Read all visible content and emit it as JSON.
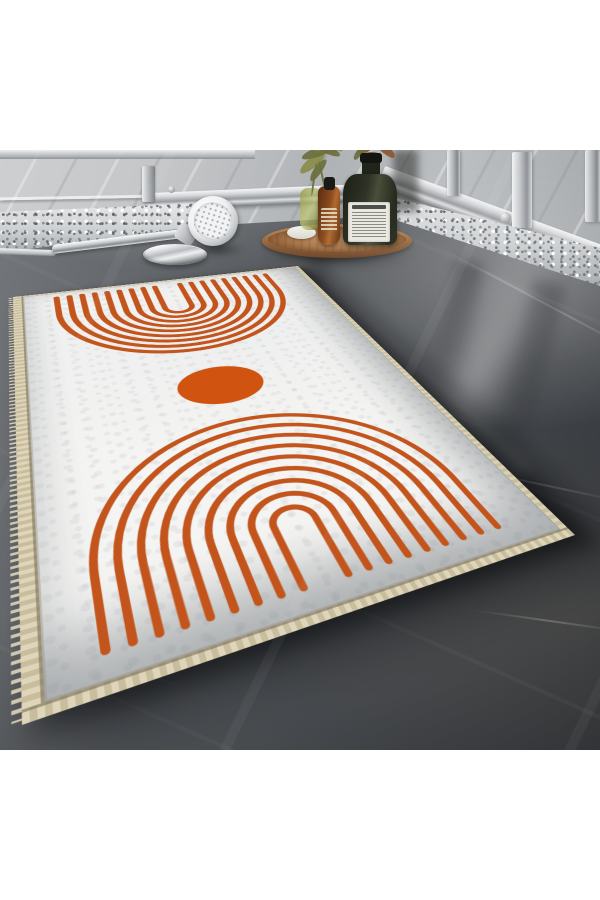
{
  "image_type": "product-photo",
  "subject": "white boho area rug with burnt-orange nested-arch motifs on a dark glossy marble bathroom floor, beside a glass shower screen, granite curb, handheld shower head and a round wooden tray with bottles and greenery",
  "palette": {
    "page-bg": "#ffffff",
    "arc": "#c2541c",
    "circle": "#d0540f",
    "rug-white": "#f4f4f2",
    "binding": "#d8cfb3",
    "binding-dark": "#c8be9e",
    "floor-dark": "#34373b",
    "floor-mid": "#54575b",
    "floor-light": "#75787c",
    "wall-light": "#cbcdcf",
    "wall-mid": "#aeb1b4",
    "granite": "#cfd2d4",
    "chrome-light": "#f4f5f6",
    "chrome-mid": "#b9bcbf",
    "chrome-dark": "#7f8285",
    "wood-light": "#c2905f",
    "wood-mid": "#a5754a",
    "wood-dark": "#6e4526",
    "bottle-glass": "#2e3326",
    "label-white": "#e9e7e0",
    "amber": "#8a4a1e",
    "green-glass": "#9aa050",
    "leaf-green": "#8c8e4b",
    "leaf-olive": "#6d713f",
    "leaf-dry": "#8a5a35"
  },
  "rug": {
    "design": {
      "canvas": {
        "w": 300,
        "h": 460
      },
      "top_motif": {
        "shape": "nested-arches",
        "opening": "up",
        "count": 9,
        "cx": 147,
        "tips_v": 14,
        "r_start": 13,
        "r_step": 11.9,
        "center_v": 70,
        "center_v_step": -2,
        "stroke": 5.5
      },
      "circle": {
        "cx": 148,
        "cy": 225,
        "rx": 34,
        "ry": 28
      },
      "bottom_motif": {
        "shape": "nested-arches",
        "opening": "down",
        "count": 9,
        "cx": 148,
        "tips_v": 437,
        "r_start": 13,
        "r_step": 12.4,
        "center_v": 390,
        "center_v_step": 0,
        "stroke": 4.5
      }
    }
  },
  "tray": {
    "leaves": [
      {
        "x": 42,
        "y": 18,
        "w": 30,
        "h": 10,
        "rot": -38,
        "c": "leaf-green"
      },
      {
        "x": 46,
        "y": 8,
        "w": 32,
        "h": 9,
        "rot": -18,
        "c": "leaf-olive"
      },
      {
        "x": 55,
        "y": 2,
        "w": 30,
        "h": 9,
        "rot": -2,
        "c": "leaf-green"
      },
      {
        "x": 60,
        "y": 6,
        "w": 26,
        "h": 8,
        "rot": 22,
        "c": "leaf-olive"
      },
      {
        "x": 50,
        "y": 26,
        "w": 26,
        "h": 8,
        "rot": -55,
        "c": "leaf-olive"
      },
      {
        "x": 68,
        "y": 0,
        "w": 22,
        "h": 7,
        "rot": 40,
        "c": "leaf-green"
      },
      {
        "x": 58,
        "y": 22,
        "w": 2,
        "h": 34,
        "rot": 8,
        "c": "leaf-olive"
      },
      {
        "x": 66,
        "y": 20,
        "w": 2,
        "h": 30,
        "rot": -12,
        "c": "leaf-olive"
      },
      {
        "x": 100,
        "y": 2,
        "w": 26,
        "h": 9,
        "rot": -30,
        "c": "leaf-dry"
      },
      {
        "x": 112,
        "y": 0,
        "w": 24,
        "h": 8,
        "rot": 10,
        "c": "leaf-dry"
      },
      {
        "x": 120,
        "y": 6,
        "w": 22,
        "h": 8,
        "rot": 38,
        "c": "leaf-dry"
      },
      {
        "x": 106,
        "y": 12,
        "w": 18,
        "h": 7,
        "rot": -8,
        "c": "leaf-dry"
      },
      {
        "x": 96,
        "y": 10,
        "w": 16,
        "h": 6,
        "rot": -52,
        "c": "leaf-olive"
      },
      {
        "x": 74,
        "y": 40,
        "w": 3,
        "h": 26,
        "rot": 14,
        "c": "leaf-olive"
      }
    ]
  },
  "scene": {
    "objects": [
      "rug",
      "arch-motif-top",
      "circle-motif",
      "arch-motif-bottom",
      "marble-floor",
      "marble-wall",
      "glass-shower-rail",
      "granite-curb",
      "shower-head",
      "shower-hose",
      "chrome-plate",
      "wooden-tray",
      "dark-glass-bottle",
      "amber-dropper-bottle",
      "green-glass-jar",
      "leaf-sprigs",
      "soap-bar"
    ]
  }
}
